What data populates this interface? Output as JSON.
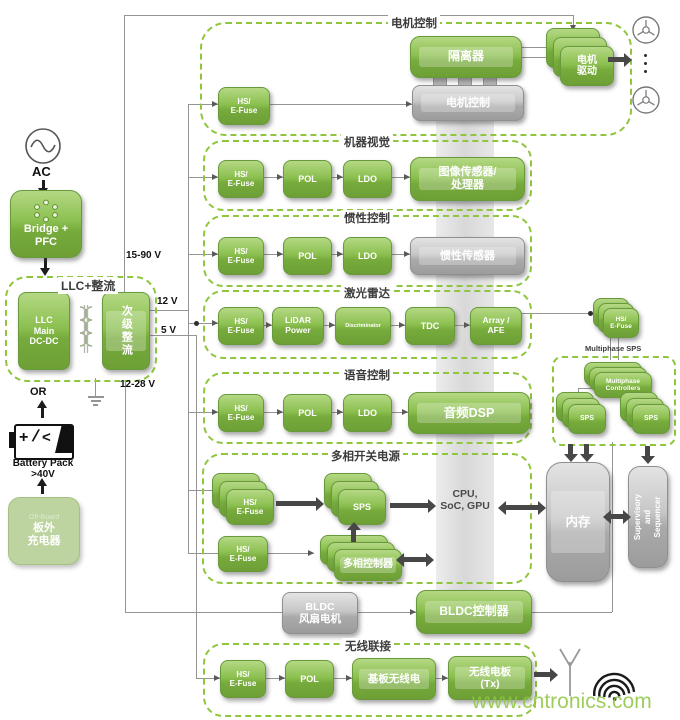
{
  "watermark": "www.cntronics.com",
  "power_input": {
    "ac": "AC",
    "bridge_pfc": "Bridge +\nPFC",
    "llc_label": "LLC+整流",
    "llc_main": "LLC\nMain\nDC-DC",
    "secondary_rectifier": "次级整流",
    "or": "OR",
    "battery_line1": "Battery Pack",
    "battery_line2": ">40V",
    "charger": "板外\n充电器",
    "charger_faint": "Off-Board"
  },
  "rails": {
    "hv": "15-90 V",
    "v12": "12 V",
    "v5": "5 V",
    "v12_28": "12-28 V"
  },
  "motor": {
    "label": "电机控制",
    "efuse": "HS/\nE-Fuse",
    "isolator": "隔离器",
    "drive": "电机\n驱动",
    "controller": "电机控制"
  },
  "vision": {
    "label": "机器视觉",
    "efuse": "HS/\nE-Fuse",
    "pol": "POL",
    "ldo": "LDO",
    "sensor": "图像传感器/\n处理器"
  },
  "inertial": {
    "label": "惯性控制",
    "efuse": "HS/\nE-Fuse",
    "pol": "POL",
    "ldo": "LDO",
    "sensor": "惯性传感器"
  },
  "lidar": {
    "label": "激光雷达",
    "efuse": "HS/\nE-Fuse",
    "power": "LiDAR\nPower",
    "discriminator": "Discriminator",
    "tdc": "TDC",
    "afe": "Array /\nAFE"
  },
  "voice": {
    "label": "语音控制",
    "efuse": "HS/\nE-Fuse",
    "pol": "POL",
    "ldo": "LDO",
    "dsp": "音频DSP"
  },
  "multiphase": {
    "label": "多相开关电源",
    "efuse1": "HS/\nE-Fuse",
    "sps": "SPS",
    "efuse2": "HS/\nE-Fuse",
    "controller": "多相控制器",
    "cpu": "CPU,\nSoC, GPU"
  },
  "memory_domain": {
    "efuse": "HS/\nE-Fuse",
    "label": "Multiphase SPS",
    "controllers": "Multiphase\nControllers",
    "sps_left": "SPS",
    "sps_right": "SPS",
    "memory": "内存",
    "supervisor": "Supervisory and Sequencer"
  },
  "bldc": {
    "fan": "BLDC\n风扇电机",
    "controller": "BLDC控制器"
  },
  "wireless": {
    "label": "无线联接",
    "efuse": "HS/\nE-Fuse",
    "pol": "POL",
    "radio": "基板无线电",
    "tx": "无线电板\n(Tx)"
  }
}
